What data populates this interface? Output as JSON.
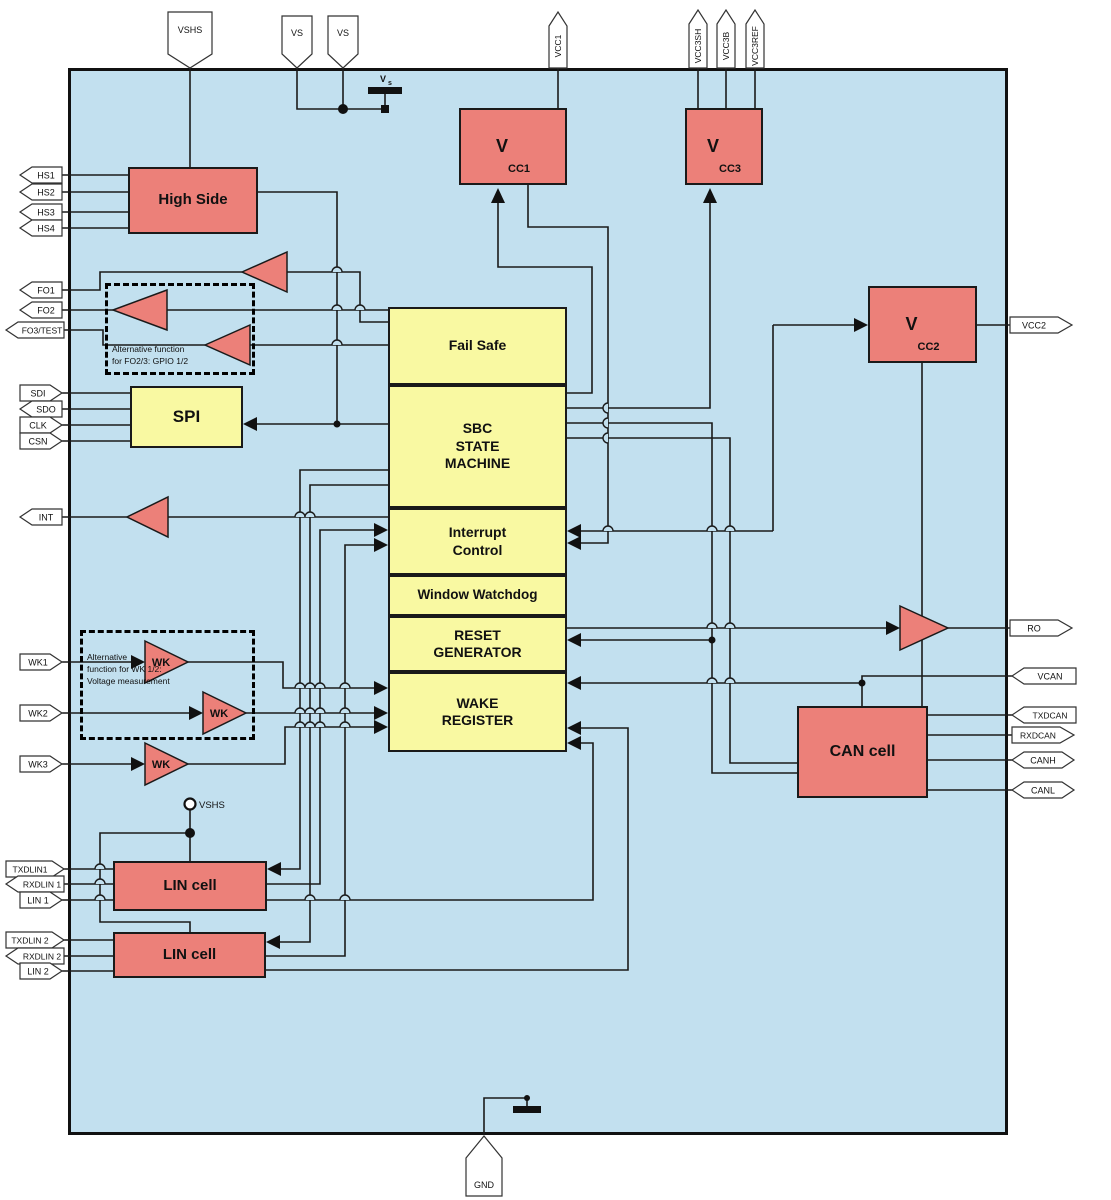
{
  "blocks": {
    "high_side": "High Side",
    "vcc1": {
      "prefix": "V",
      "sub": "CC1"
    },
    "vcc3": {
      "prefix": "V",
      "sub": "CC3"
    },
    "vcc2": {
      "prefix": "V",
      "sub": "CC2"
    },
    "fail_safe": "Fail Safe",
    "sbc_state_machine": "SBC\nSTATE\nMACHINE",
    "interrupt_control": "Interrupt\nControl",
    "window_watchdog": "Window Watchdog",
    "reset_generator": "RESET\nGENERATOR",
    "wake_register": "WAKE\nREGISTER",
    "spi": "SPI",
    "can_cell": "CAN cell",
    "lin_cell_1": "LIN cell",
    "lin_cell_2": "LIN cell",
    "wk": "WK"
  },
  "pins": {
    "top": [
      "VSHS",
      "VS",
      "VS",
      "VCC1",
      "VCC3SH",
      "VCC3B",
      "VCC3REF"
    ],
    "left": [
      "HS1",
      "HS2",
      "HS3",
      "HS4",
      "FO1",
      "FO2",
      "FO3/TEST",
      "SDI",
      "SDO",
      "CLK",
      "CSN",
      "INT",
      "WK1",
      "WK2",
      "WK3",
      "TXDLIN1",
      "RXDLIN 1",
      "LIN 1",
      "TXDLIN 2",
      "RXDLIN 2",
      "LIN 2"
    ],
    "right": [
      "VCC2",
      "RO",
      "VCAN",
      "TXDCAN",
      "RXDCAN",
      "CANH",
      "CANL"
    ],
    "bottom": [
      "GND"
    ]
  },
  "annotations": {
    "fo_alt": "Alternative function\nfor FO2/3: GPIO 1/2",
    "wk_alt": "Alternative\nfunction for WK 1/2:\nVoltage measurement",
    "vs": {
      "prefix": "V",
      "sub": "s"
    },
    "vshs_node": "VSHS"
  },
  "colors": {
    "chip_bg": "#c2e0ef",
    "block_red": "#ec8079",
    "block_yellow": "#f9f9a2",
    "wire": "#1a1a1a",
    "pin_fill": "#ffffff"
  }
}
